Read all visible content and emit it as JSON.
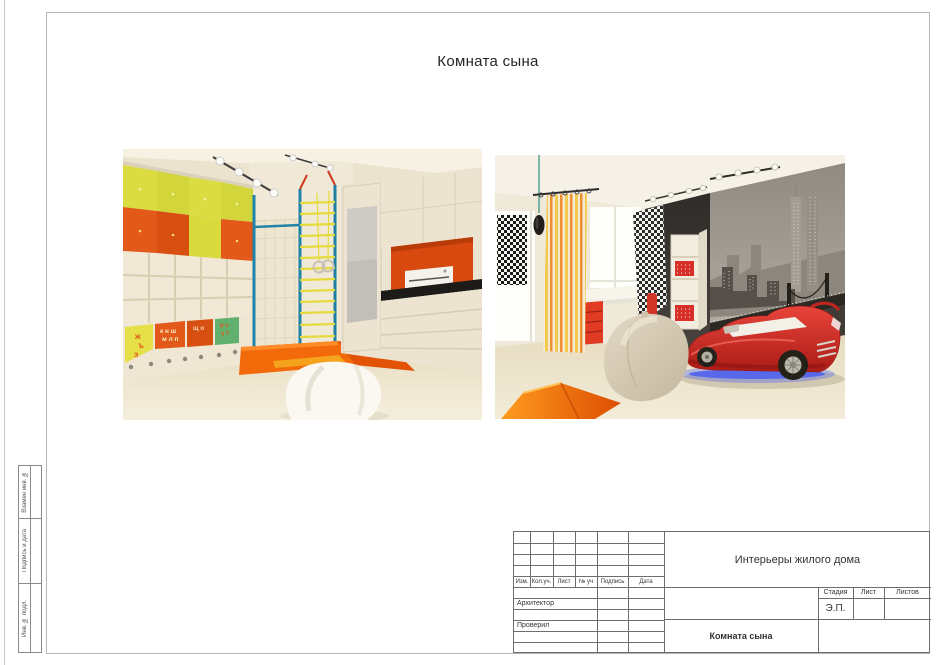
{
  "page": {
    "title": "Комната сына"
  },
  "stamp": {
    "header_cols": [
      "Изм.",
      "Кол.уч.",
      "Лист",
      "№ уч",
      "Подпись",
      "Дата"
    ],
    "role_architect": "Архитектор",
    "role_checked": "Проверил",
    "project_title": "Интерьеры жилого дома",
    "sheet_title": "Комната сына",
    "stage_label": "Стадия",
    "sheet_label": "Лист",
    "sheets_label": "Листов",
    "stage_value": "Э.П."
  },
  "margin_labels": {
    "replace_inv": "Взамен инв. №",
    "sign_date": "Подпись и дата",
    "inv_orig": "Инв. № подл."
  },
  "left_render": {
    "letters": [
      "ж",
      "ъ",
      "э",
      "к н ш",
      "м л п",
      "щ о",
      "р с",
      "у т"
    ]
  },
  "colors": {
    "accent_orange": "#e2591a",
    "cabinet_yellow": "#d9d83b",
    "pole_teal": "#2084a8",
    "car_red": "#d42422",
    "underglow_blue": "#4a5ef0"
  }
}
